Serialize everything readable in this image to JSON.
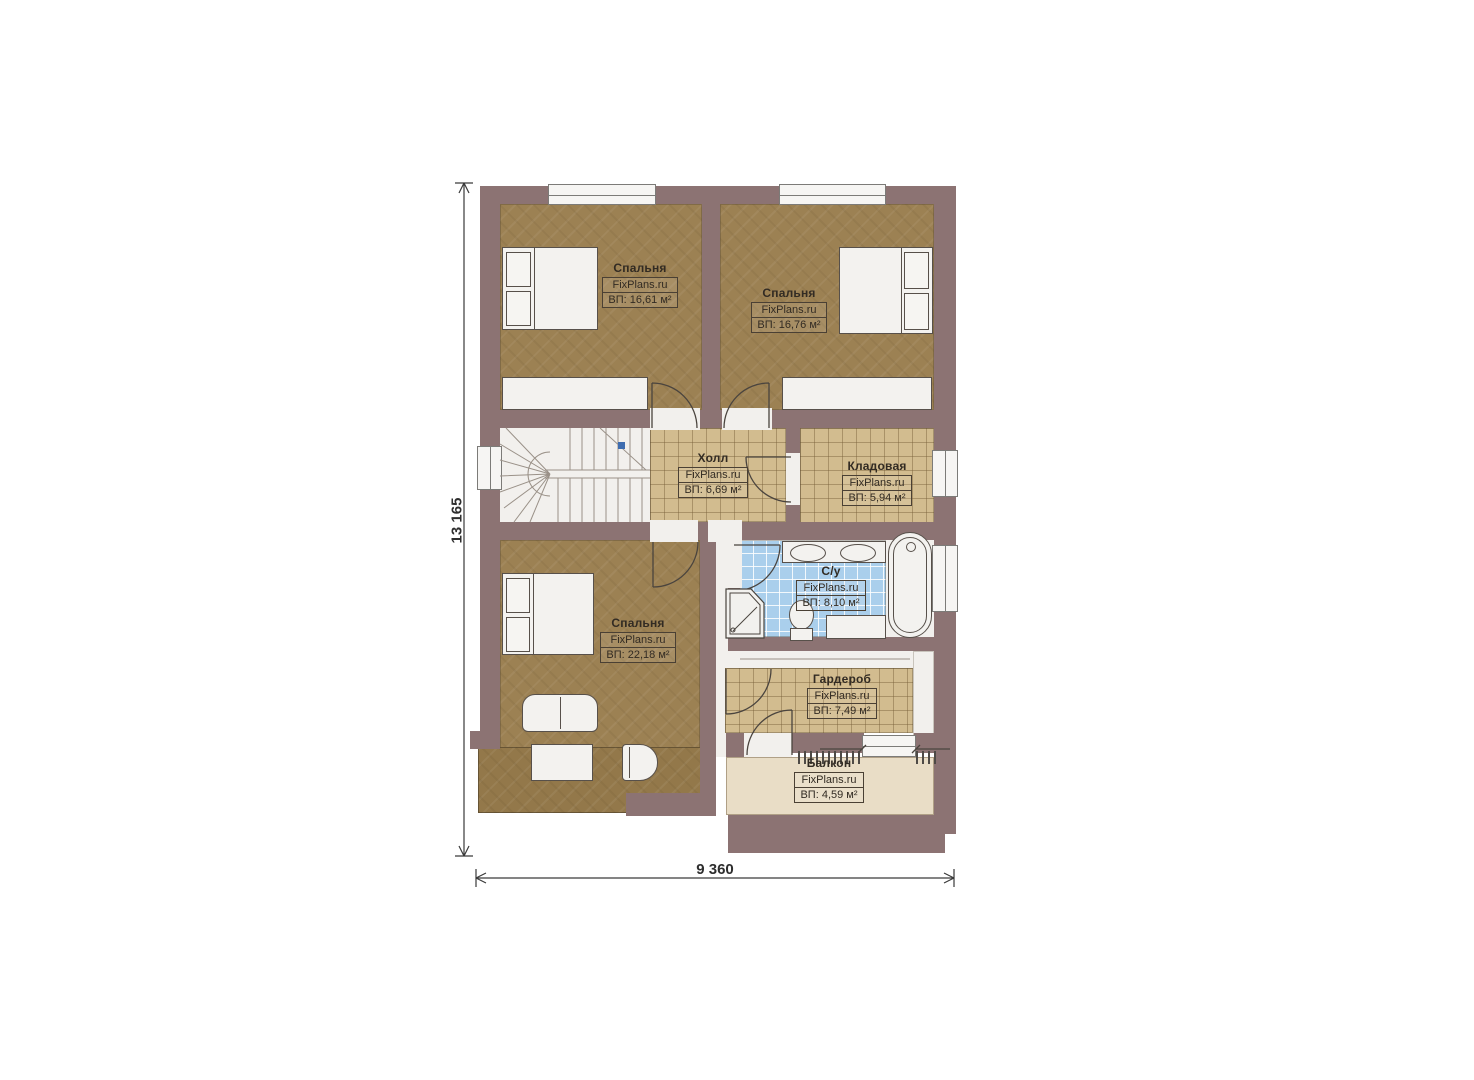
{
  "plan": {
    "type": "floor-plan-2nd-floor",
    "dimension_width": "9 360",
    "dimension_height": "13 165",
    "colors": {
      "wall": "#8c7373",
      "wood": "#9c8153",
      "tile": "#d2bc8f",
      "bath": "#aacfec",
      "balcony": "#e9ddc6",
      "white": "#f2f0ed",
      "line": "#4a443e",
      "blue": "#3f6db0"
    },
    "rooms": [
      {
        "id": "bedroom-top-left",
        "name": "Спальня",
        "brand": "FixPlans.ru",
        "area": "ВП: 16,61 м²"
      },
      {
        "id": "bedroom-top-right",
        "name": "Спальня",
        "brand": "FixPlans.ru",
        "area": "ВП: 16,76 м²"
      },
      {
        "id": "hall",
        "name": "Холл",
        "brand": "FixPlans.ru",
        "area": "ВП: 6,69 м²"
      },
      {
        "id": "storage",
        "name": "Кладовая",
        "brand": "FixPlans.ru",
        "area": "ВП: 5,94 м²"
      },
      {
        "id": "bathroom",
        "name": "С/у",
        "brand": "FixPlans.ru",
        "area": "ВП: 8,10 м²"
      },
      {
        "id": "bedroom-bottom",
        "name": "Спальня",
        "brand": "FixPlans.ru",
        "area": "ВП: 22,18 м²"
      },
      {
        "id": "wardrobe",
        "name": "Гардероб",
        "brand": "FixPlans.ru",
        "area": "ВП: 7,49 м²"
      },
      {
        "id": "balcony",
        "name": "Балкон",
        "brand": "FixPlans.ru",
        "area": "ВП: 4,59 м²"
      }
    ]
  }
}
